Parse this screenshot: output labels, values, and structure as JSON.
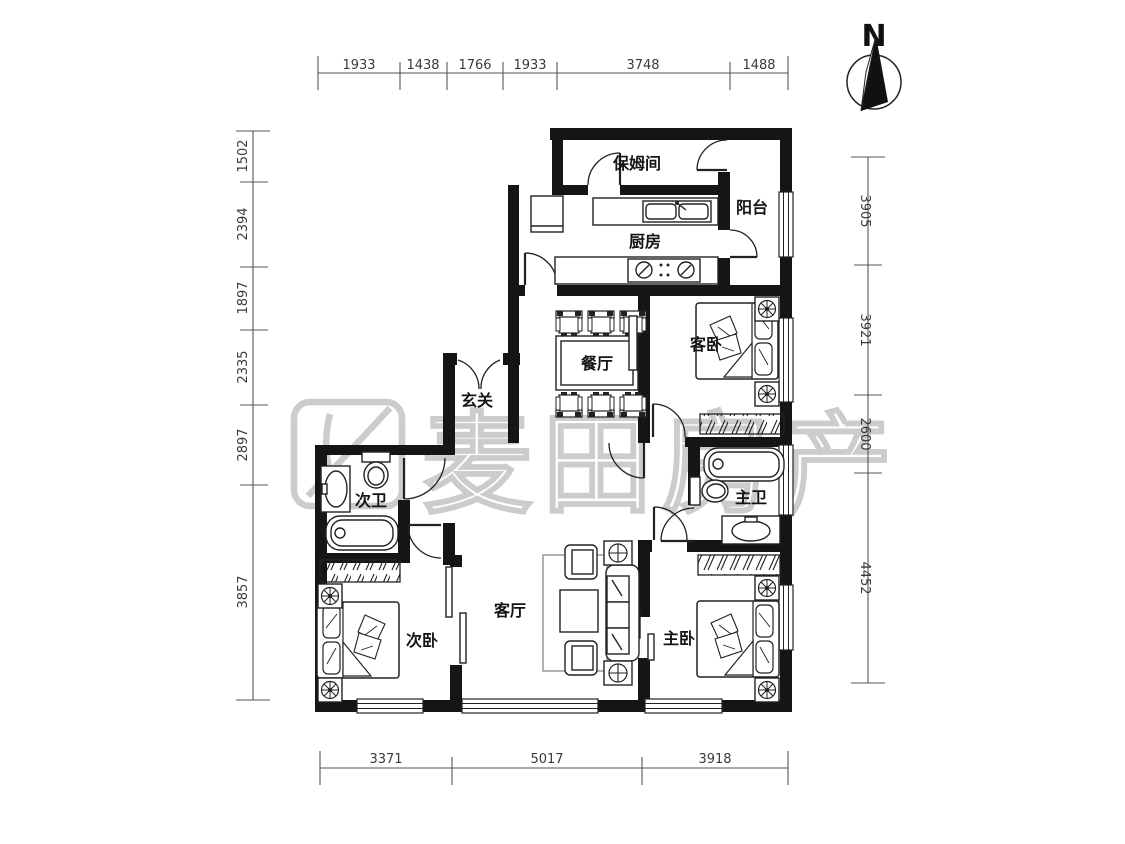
{
  "compass": {
    "north": "N"
  },
  "watermark": {
    "brand": "麦田房产"
  },
  "rooms": {
    "nanny": "保姆间",
    "balcony": "阳台",
    "kitchen": "厨房",
    "dining": "餐厅",
    "guest": "客卧",
    "foyer": "玄关",
    "bath2": "次卫",
    "bath1": "主卫",
    "living": "客厅",
    "bed2": "次卧",
    "bed1": "主卧"
  },
  "dims": {
    "top": [
      "1933",
      "1438",
      "1766",
      "1933",
      "3748",
      "1488"
    ],
    "left": [
      "1502",
      "2394",
      "1897",
      "2335",
      "2897",
      "3857"
    ],
    "right": [
      "3905",
      "3921",
      "2600",
      "4452"
    ],
    "bottom": [
      "3371",
      "5017",
      "3918"
    ]
  }
}
